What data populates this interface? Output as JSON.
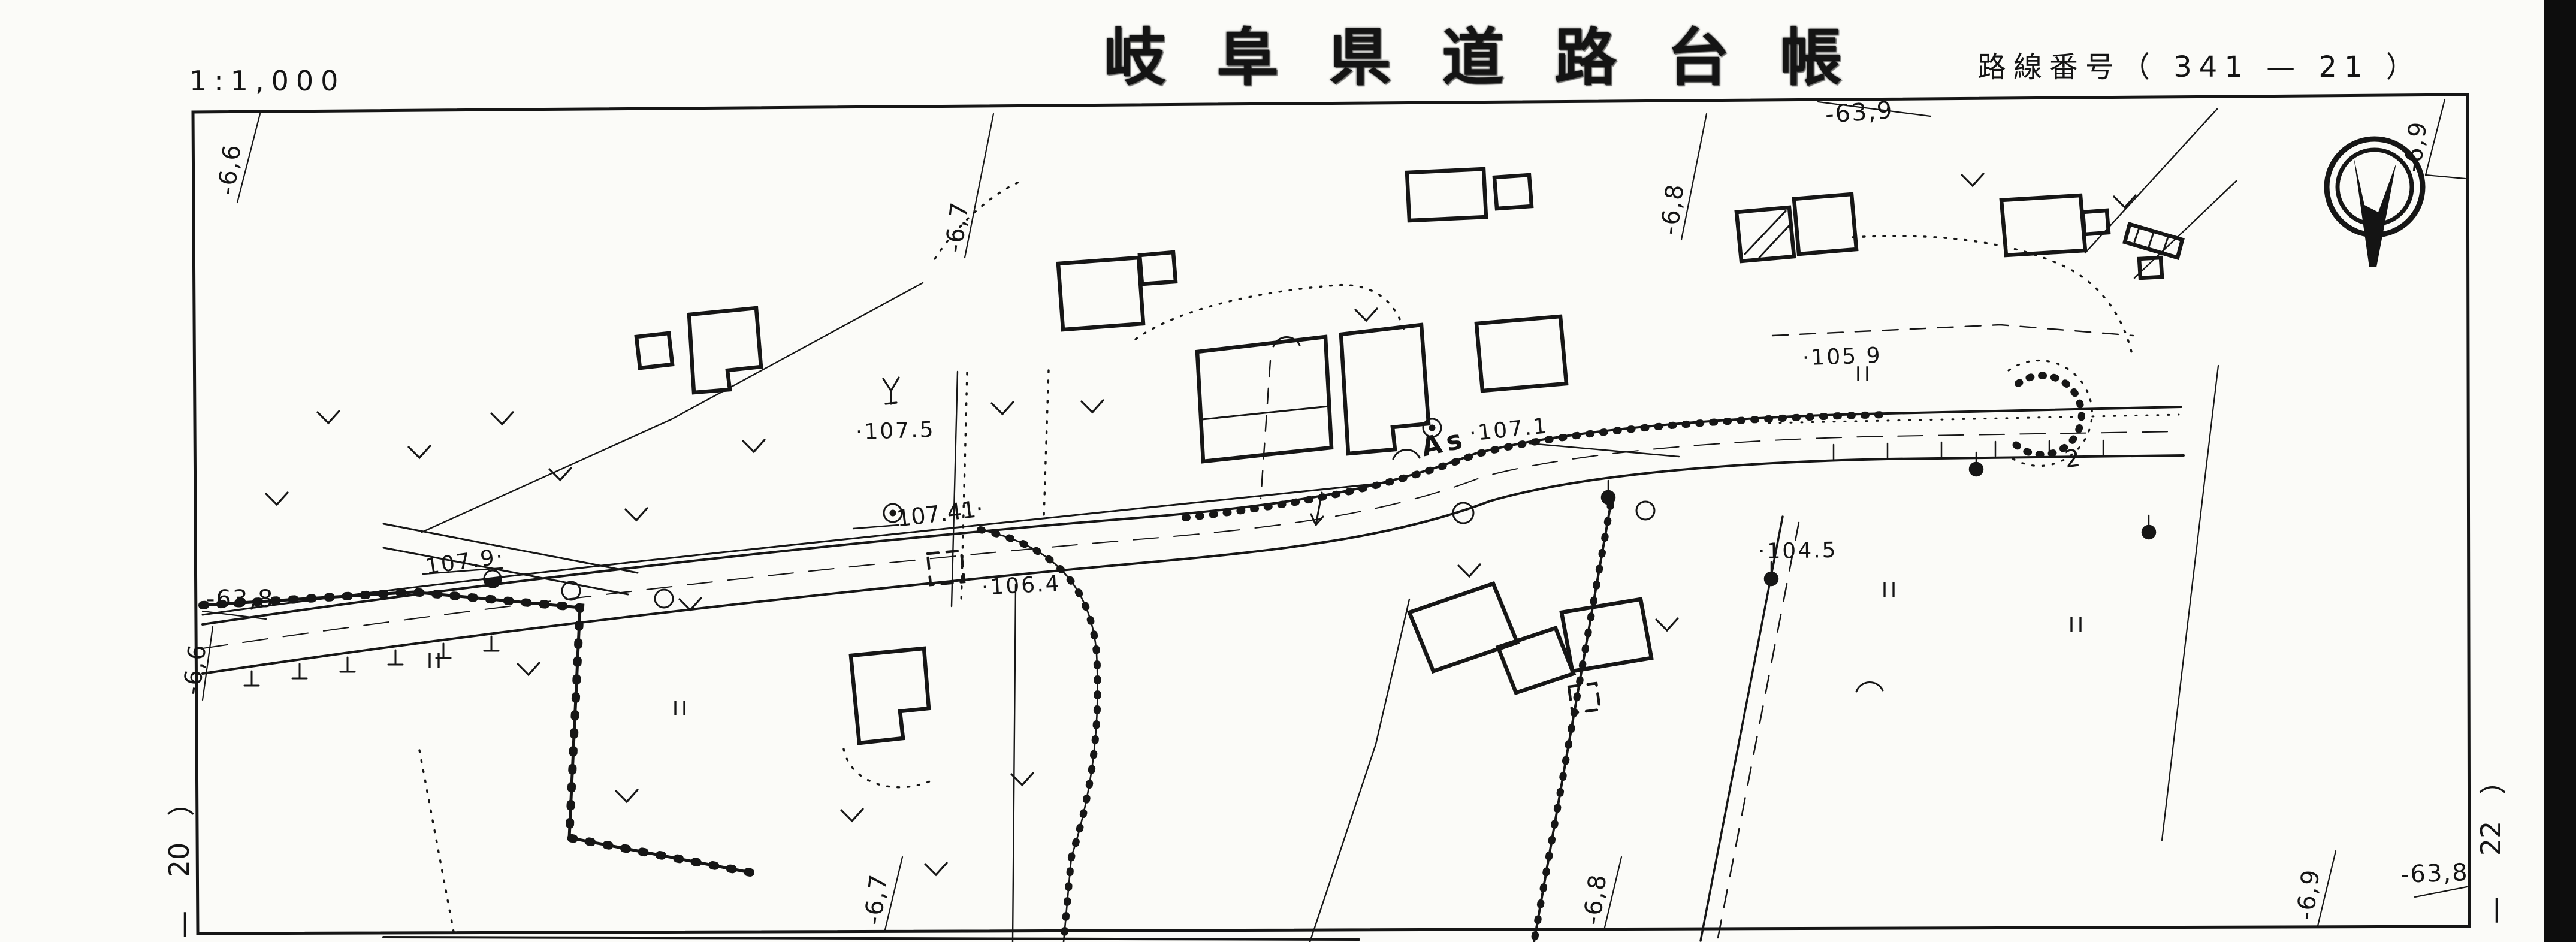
{
  "header": {
    "scale": "1:1,000",
    "title": "岐阜県道路台帳",
    "route": "路線番号（ 341 — 21 ）"
  },
  "grid": {
    "top": [
      "-6,6",
      "-6,7",
      "-6,8",
      "-63,9",
      "-6,9"
    ],
    "bottom": [
      "-6,7",
      "-6,8",
      "-6,9"
    ],
    "left_y": "-63,8",
    "left_x": "-6,6",
    "right_y": "-63,8"
  },
  "sheet_links": {
    "left": {
      "paren": "）",
      "number": "20",
      "dash": "—"
    },
    "right": {
      "paren": "）",
      "number": "22",
      "dash": "—"
    }
  },
  "map_labels": {
    "spot_elevations": [
      "·107.5",
      "107.41·",
      "107.9·",
      "·106.4",
      "·107.1",
      "·105 9",
      "·104.5"
    ],
    "road_surface": "As",
    "lot_number": "2",
    "paddy_symbol": "II"
  }
}
